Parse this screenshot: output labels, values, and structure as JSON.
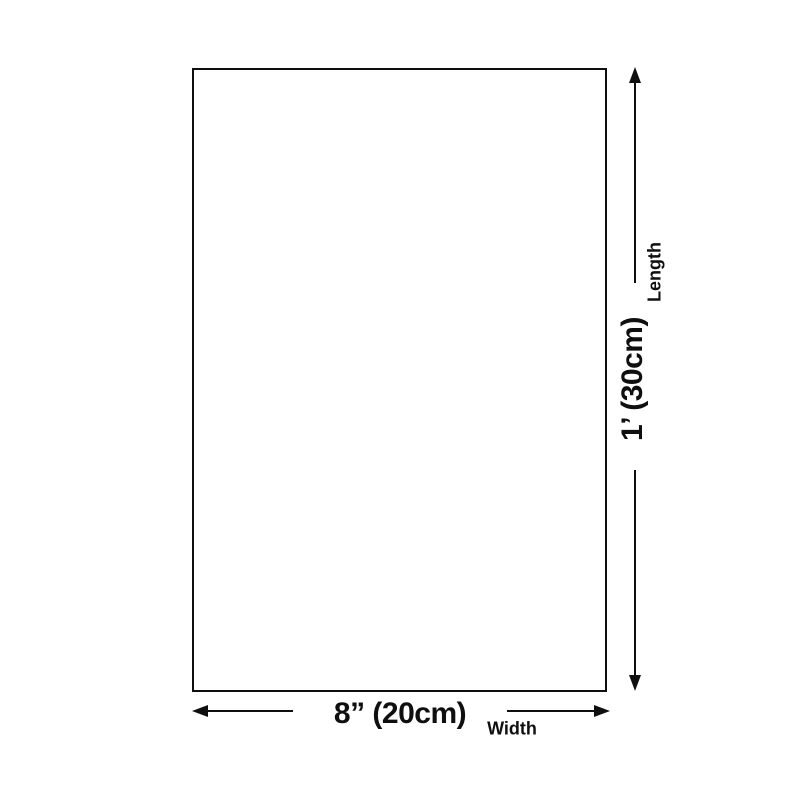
{
  "diagram": {
    "type": "product-dimension-diagram",
    "background_color": "#ffffff",
    "ink_color": "#0f0f0f",
    "product_box": {
      "shape": "rectangle",
      "fill": "#ffffff",
      "border_color": "#0f0f0f"
    },
    "length_dimension": {
      "axis_label": "Length",
      "value": "1’ (30cm)",
      "arrow": "double-headed-vertical",
      "text_orientation": "rotated-90-ccw"
    },
    "width_dimension": {
      "axis_label": "Width",
      "value": "8” (20cm)",
      "arrow": "double-headed-horizontal",
      "text_orientation": "horizontal"
    }
  }
}
